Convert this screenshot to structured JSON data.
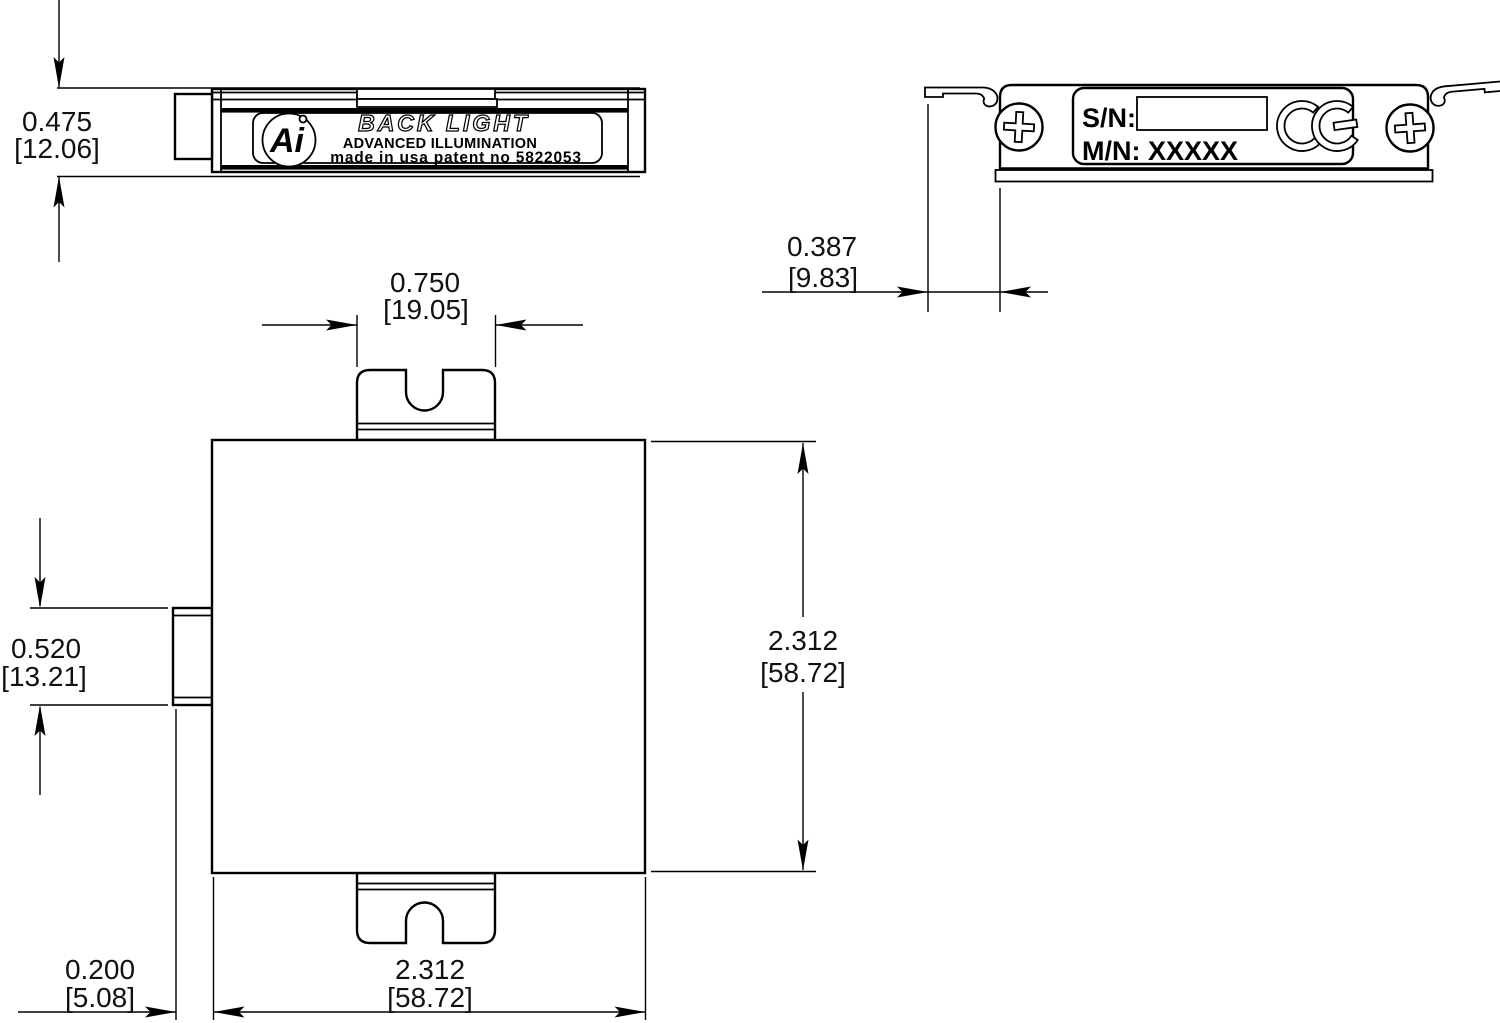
{
  "drawing": {
    "side_view": {
      "label_line1": "BACK LIGHT",
      "label_line2": "ADVANCED ILLUMINATION",
      "label_line3": "made in usa patent no 5822053",
      "logo_text": "Ai"
    },
    "back_view": {
      "serial_label": "S/N:",
      "model_label": "M/N: XXXXX",
      "ce_mark": "CE"
    },
    "dimensions": {
      "thickness": {
        "inches": "0.475",
        "mm": "[12.06]"
      },
      "tab_width": {
        "inches": "0.750",
        "mm": "[19.05]"
      },
      "bracket_offset": {
        "inches": "0.387",
        "mm": "[9.83]"
      },
      "connector_height": {
        "inches": "0.520",
        "mm": "[13.21]"
      },
      "body_height": {
        "inches": "2.312",
        "mm": "[58.72]"
      },
      "connector_depth": {
        "inches": "0.200",
        "mm": "[5.08]"
      },
      "body_width": {
        "inches": "2.312",
        "mm": "[58.72]"
      }
    }
  }
}
